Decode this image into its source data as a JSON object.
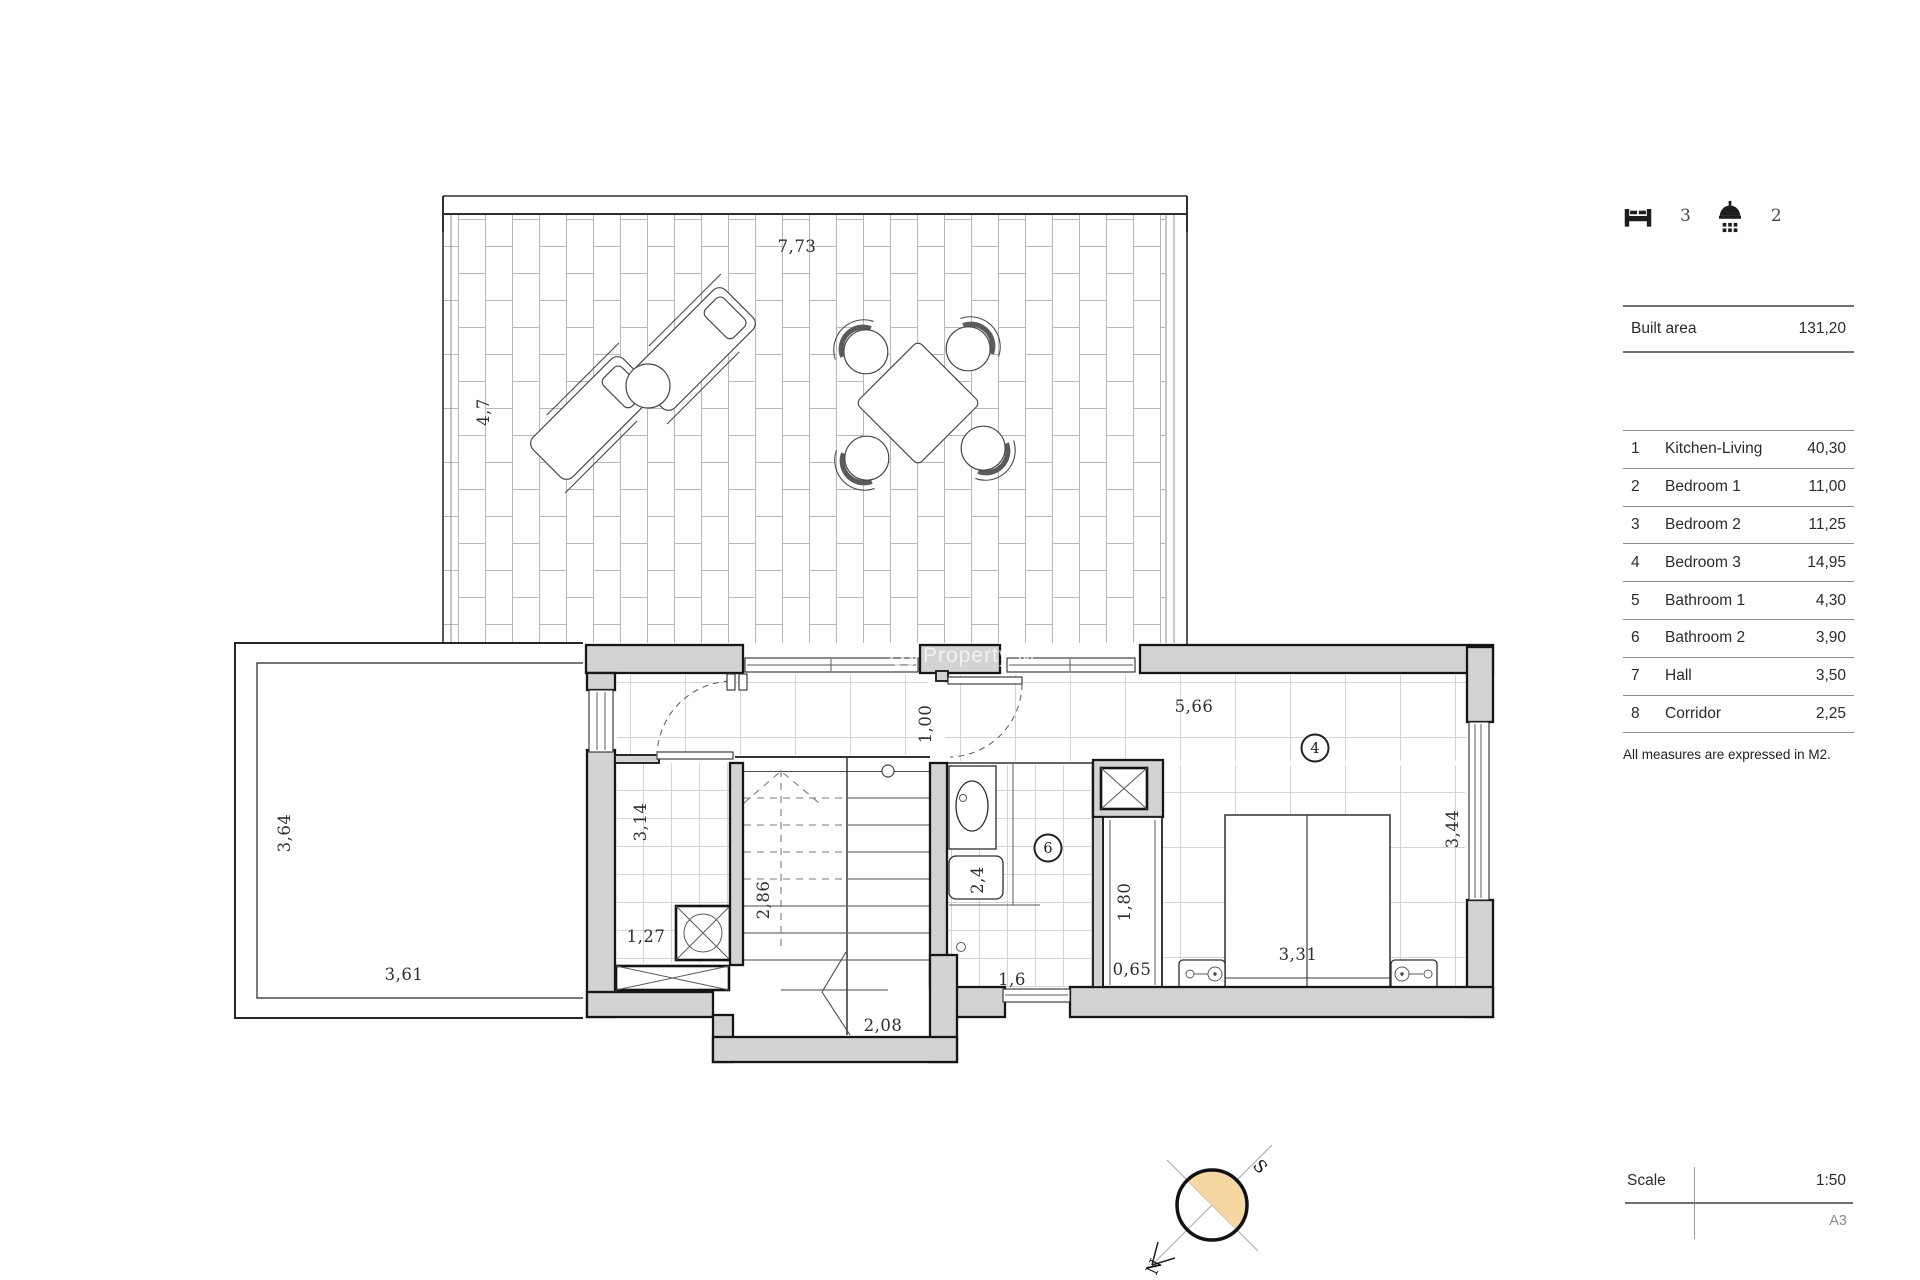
{
  "summary": {
    "bedrooms_count": "3",
    "bathrooms_count": "2"
  },
  "built_area": {
    "label": "Built area",
    "value": "131,20"
  },
  "rooms": [
    {
      "num": "1",
      "name": "Kitchen-Living",
      "area": "40,30"
    },
    {
      "num": "2",
      "name": "Bedroom 1",
      "area": "11,00"
    },
    {
      "num": "3",
      "name": "Bedroom 2",
      "area": "11,25"
    },
    {
      "num": "4",
      "name": "Bedroom 3",
      "area": "14,95"
    },
    {
      "num": "5",
      "name": "Bathroom 1",
      "area": "4,30"
    },
    {
      "num": "6",
      "name": "Bathroom 2",
      "area": "3,90"
    },
    {
      "num": "7",
      "name": "Hall",
      "area": "3,50"
    },
    {
      "num": "8",
      "name": "Corridor",
      "area": "2,25"
    }
  ],
  "footnote": "All measures are expressed in M2.",
  "scale": {
    "label": "Scale",
    "value": "1:50",
    "sheet": "A3"
  },
  "compass": {
    "north": "N",
    "south": "S"
  },
  "watermark": {
    "logo": "W",
    "text": "Property M"
  },
  "plan": {
    "markers": {
      "bedroom3": "4",
      "bathroom2": "6"
    },
    "dims": {
      "terrace_w": "7,73",
      "terrace_h": "4,7",
      "porch_h": "3,64",
      "porch_w": "3,61",
      "room5_h": "3,14",
      "room5_w": "1,27",
      "stair_h": "2,86",
      "stair_w": "2,08",
      "corridor_w": "1,00",
      "bath_win": "1,6",
      "bath_d": "2,4",
      "closet_h": "1,80",
      "closet_w": "0,65",
      "bed3_w": "5,66",
      "bed_w": "3,31",
      "bed3_h": "3,44"
    },
    "colors": {
      "wall_fill": "#d3d3d3",
      "compass_fill": "#f6d7a1",
      "tile_line": "#b8b8b8"
    }
  }
}
